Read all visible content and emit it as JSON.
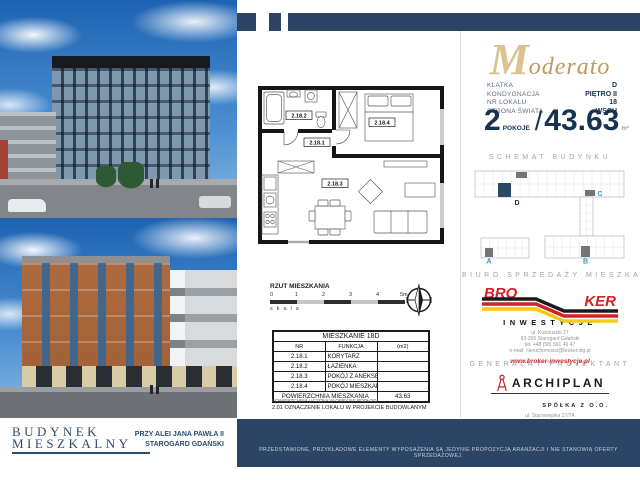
{
  "logo": {
    "initial": "M",
    "rest": "oderato"
  },
  "unit_info": {
    "rows": [
      {
        "label": "KLATKA",
        "value": "D"
      },
      {
        "label": "KONDYGNACJA",
        "value": "PIĘTRO II"
      },
      {
        "label": "NR LOKALU",
        "value": "18"
      },
      {
        "label": "STRONA ŚWIATA",
        "value": "WSCH"
      }
    ],
    "rooms_value": "2",
    "rooms_label": "POKOJE",
    "slash": "/",
    "area_value": "43.63",
    "area_unit": "m²"
  },
  "schematic": {
    "heading": "SCHEMAT BUDYNKU",
    "sections": [
      "A",
      "B",
      "C",
      "D"
    ]
  },
  "plan": {
    "caption": "RZUT MIESZKANIA",
    "scale_word": "skala",
    "ticks": [
      "0",
      "1",
      "2",
      "3",
      "4",
      "5m"
    ],
    "rooms": [
      "2.18.1",
      "2.18.2",
      "2.18.3",
      "2.18.4"
    ]
  },
  "table": {
    "title": "MIESZKANIE 18D",
    "col_nr": "NR",
    "col_funkcja": "FUNKCJA",
    "col_m2": "(m2)",
    "rows": [
      {
        "nr": "2.18.1",
        "funkcja": "KORYTARZ"
      },
      {
        "nr": "2.18.2",
        "funkcja": "ŁAZIENKA"
      },
      {
        "nr": "2.18.3",
        "funkcja": "POKÓJ Z ANEKSEM KUCHENNYM"
      },
      {
        "nr": "2.18.4",
        "funkcja": "POKÓJ MIESZKALNY/SYPIALNIA"
      }
    ],
    "total_label": "POWIERZCHNIA MIESZKANIA",
    "total_value": "43.63",
    "note1": "POWIERZCHNIA LICZONA W OBRYSIE PODŁOGI",
    "note2": "2.01 OZNACZENIE LOKALU W PROJEKCIE BUDOWLANYM"
  },
  "sales_office": {
    "heading": "BIURO SPRZEDAŻY MIESZKAŃ",
    "brand_part1": "BRO",
    "brand_part2": "KER",
    "brand_sub": "INWESTYCJE",
    "address_line1": "ul. Kościuszki 27",
    "address_line2": "83-200 Starogard Gdański",
    "address_line3": "tel. +48 (58) 561 49 47",
    "address_line4": "e-mail: nieruchomosci@broker.stg.pl",
    "website": "www.broker-inwestycje.pl"
  },
  "designer": {
    "heading": "GENERALNY PROJEKTANT",
    "brand": "ARCHIPLAN",
    "brand_sub": "SPÓŁKA Z O.O.",
    "address_line1": "ul. Starowiejska 17/7A",
    "address_line2": "81-356 Gdynia",
    "address_line3": "tel.: (58) 621 10 99, (58) 661 80 18"
  },
  "brand": {
    "line1": "BUDYNEK",
    "line2": "MIESZKALNY",
    "sub1": "PRZY ALEI JANA PAWŁA II",
    "sub2": "STAROGARD GDAŃSKI"
  },
  "footer": {
    "disclaimer": "PRZEDSTAWIONE, PRZYKŁADOWE ELEMENTY WYPOSAŻENIA SĄ JEDYNIE PROPOZYCJĄ ARANŻACJI I NIE STANOWIĄ OFERTY SPRZEDAŻOWEJ."
  },
  "colors": {
    "navy": "#2c4565",
    "navy_text": "#16334f",
    "gold": "#bb9a5e",
    "heading_gray": "#9ba4ac",
    "broker_red": "#d52127",
    "broker_yellow": "#f2ca18",
    "section_teal": "#2a9bb5"
  }
}
